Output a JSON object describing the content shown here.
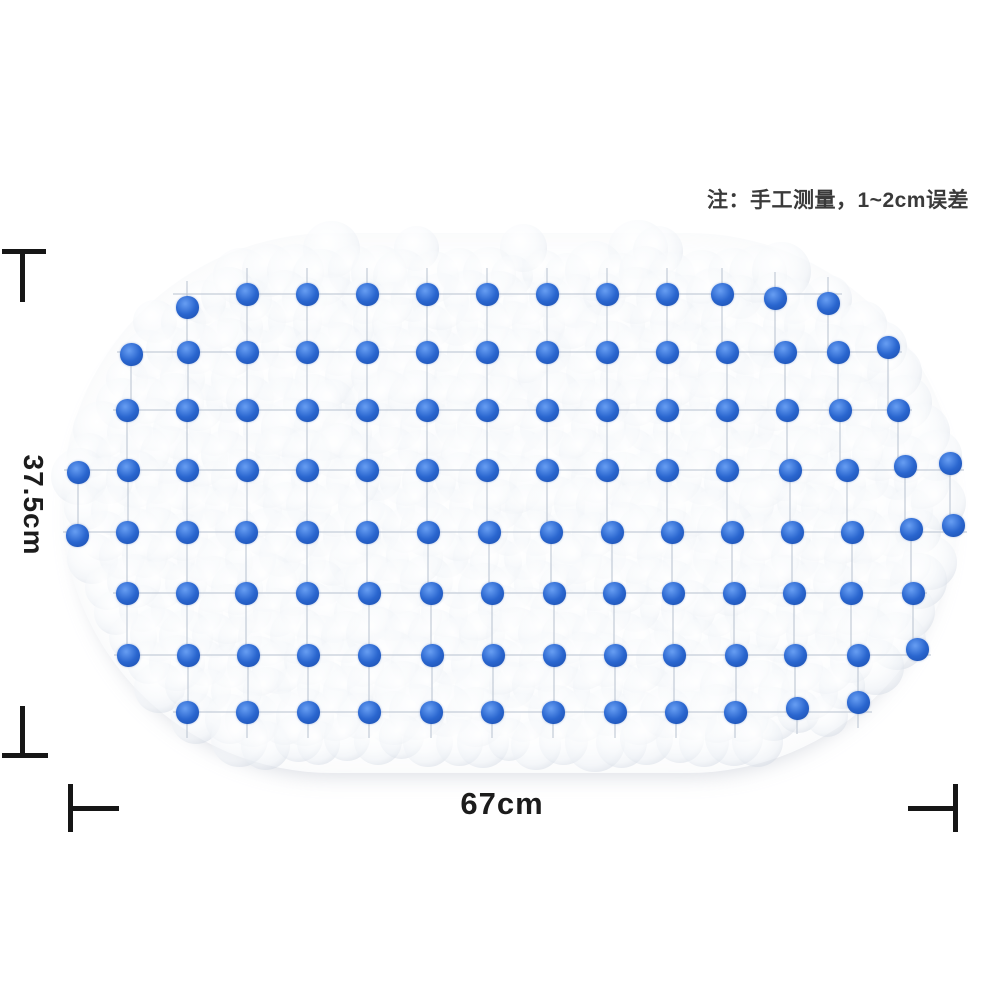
{
  "note": {
    "text": "注：手工测量，1~2cm误差"
  },
  "dimensions": {
    "height_label": "37.5cm",
    "width_label": "67cm"
  },
  "colors": {
    "dot-blue": "#2a66cf",
    "line-black": "#161616",
    "note-color": "#3a3a3a",
    "label-color": "#1c1c1c",
    "texture-ring": "rgba(197,205,218,0.42)",
    "grid-line": "rgba(190,198,212,0.55)"
  },
  "mat": {
    "x": 62,
    "y": 233,
    "width": 896,
    "height": 540,
    "dot_diameter": 23,
    "rows": [
      {
        "y": 294,
        "xs": [
          187,
          247,
          307,
          367,
          427,
          487,
          547,
          607,
          667,
          722,
          775,
          828
        ],
        "dys": [
          13,
          0,
          0,
          0,
          0,
          0,
          0,
          0,
          0,
          0,
          4,
          9
        ]
      },
      {
        "y": 352,
        "xs": [
          131,
          188,
          247,
          307,
          367,
          427,
          487,
          547,
          607,
          667,
          727,
          785,
          838,
          888
        ],
        "dys": [
          2,
          0,
          0,
          0,
          0,
          0,
          0,
          0,
          0,
          0,
          0,
          0,
          0,
          -5
        ]
      },
      {
        "y": 410,
        "xs": [
          127,
          187,
          247,
          307,
          367,
          427,
          487,
          547,
          607,
          667,
          727,
          787,
          840,
          898
        ]
      },
      {
        "y": 470,
        "xs": [
          78,
          128,
          187,
          247,
          307,
          367,
          427,
          487,
          547,
          607,
          667,
          727,
          790,
          847,
          905,
          950
        ],
        "dys": [
          2,
          0,
          0,
          0,
          0,
          0,
          0,
          0,
          0,
          0,
          0,
          0,
          0,
          0,
          -4,
          -7
        ]
      },
      {
        "y": 532,
        "xs": [
          77,
          127,
          187,
          246,
          307,
          367,
          428,
          489,
          551,
          612,
          672,
          732,
          792,
          852,
          911,
          953
        ],
        "dys": [
          3,
          0,
          0,
          0,
          0,
          0,
          0,
          0,
          0,
          0,
          0,
          0,
          0,
          0,
          -3,
          -7
        ]
      },
      {
        "y": 593,
        "xs": [
          127,
          187,
          246,
          307,
          369,
          431,
          492,
          554,
          614,
          673,
          734,
          794,
          851,
          913
        ]
      },
      {
        "y": 655,
        "xs": [
          128,
          188,
          248,
          308,
          369,
          432,
          493,
          554,
          615,
          674,
          736,
          795,
          858,
          917
        ],
        "dys": [
          0,
          0,
          0,
          0,
          0,
          0,
          0,
          0,
          0,
          0,
          0,
          0,
          0,
          -6
        ]
      },
      {
        "y": 712,
        "xs": [
          187,
          247,
          308,
          369,
          431,
          492,
          553,
          615,
          676,
          735,
          797,
          858
        ],
        "dys": [
          0,
          0,
          0,
          0,
          0,
          0,
          0,
          0,
          0,
          0,
          -4,
          -10
        ]
      }
    ]
  }
}
